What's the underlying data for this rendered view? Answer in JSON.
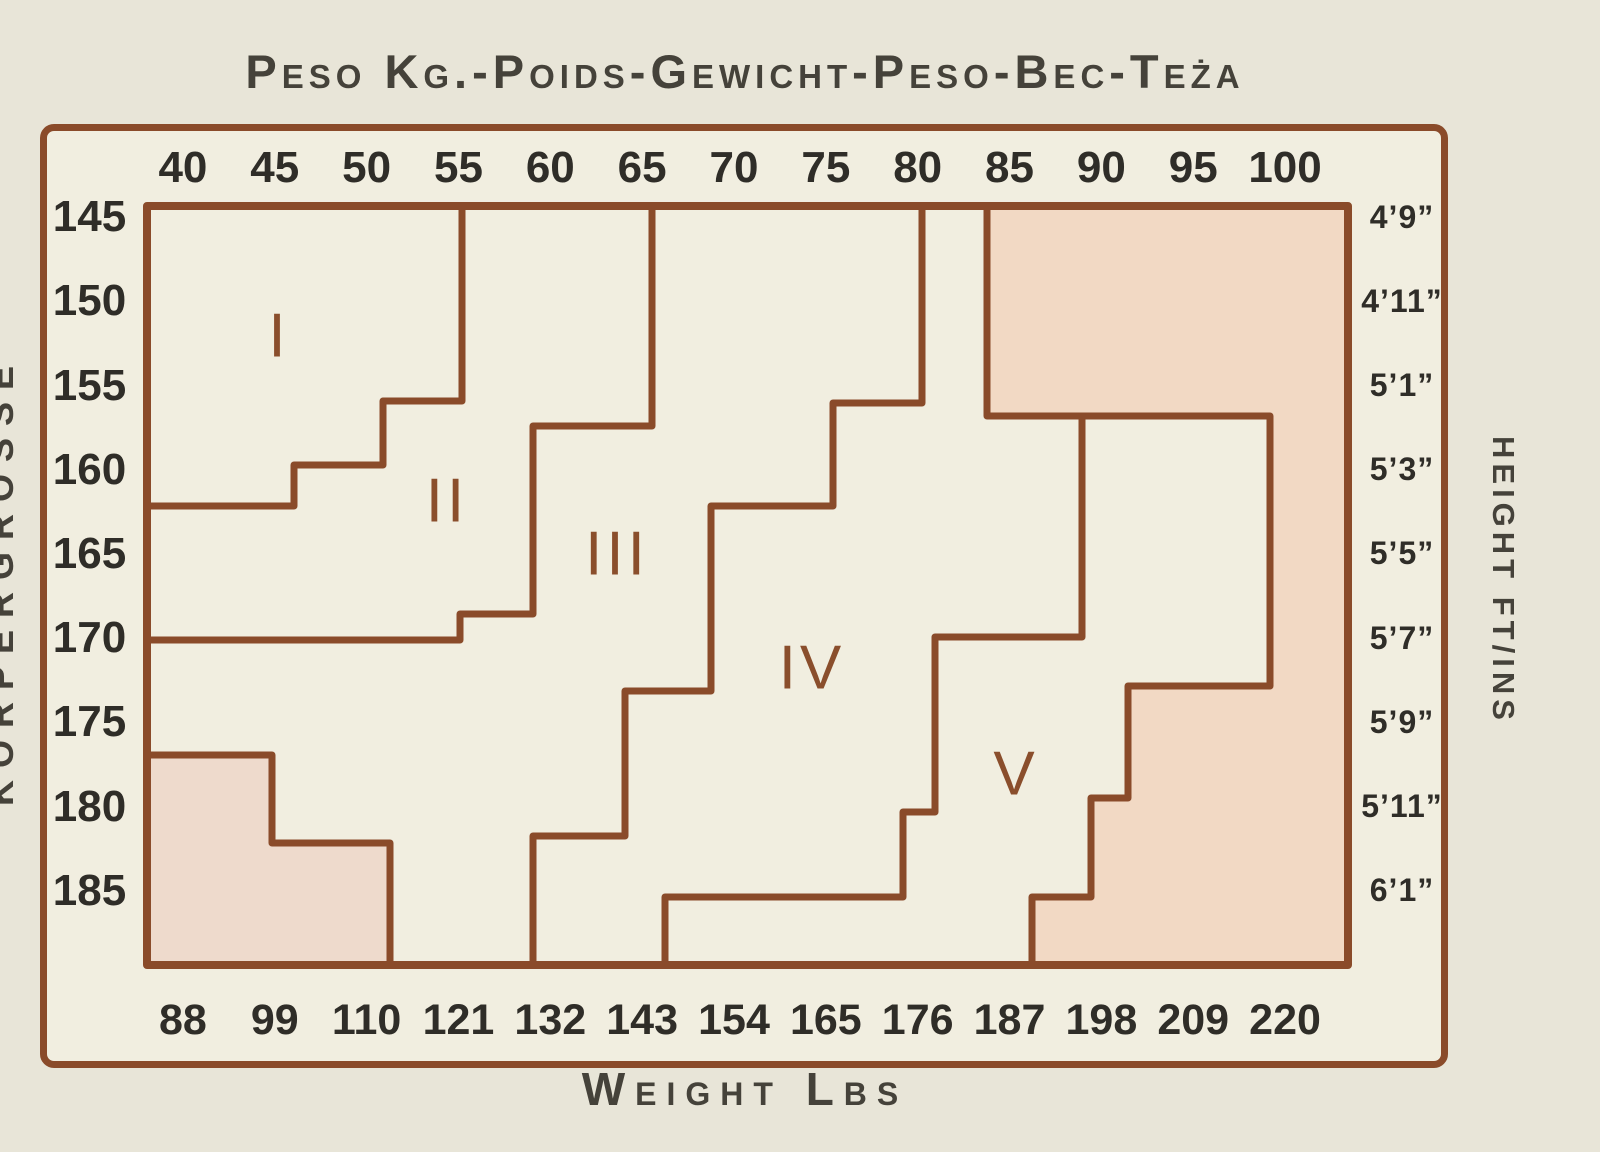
{
  "title": "Peso Kg.-Poids-Gewicht-Peso-Bec-Teża",
  "axes": {
    "weight_kg": [
      "40",
      "45",
      "50",
      "55",
      "60",
      "65",
      "70",
      "75",
      "80",
      "85",
      "90",
      "95",
      "100"
    ],
    "weight_lbs": [
      "88",
      "99",
      "110",
      "121",
      "132",
      "143",
      "154",
      "165",
      "176",
      "187",
      "198",
      "209",
      "220"
    ],
    "height_cm": [
      "145",
      "150",
      "155",
      "160",
      "165",
      "170",
      "175",
      "180",
      "185"
    ],
    "height_ftin": [
      "4’9”",
      "4’11”",
      "5’1”",
      "5’3”",
      "5’5”",
      "5’7”",
      "5’9”",
      "5’11”",
      "6’1”"
    ],
    "bottom_title": "Weight Lbs",
    "right_title": "HEIGHT FT/INS",
    "left_title": "KÖRPERGRÖSSE"
  },
  "colors": {
    "page_bg": "#e8e5d8",
    "chart_bg": "#f1eee0",
    "line": "#8a4b2a",
    "shaded_region": "#f2d9c4",
    "shaded_region_2": "#eedacc",
    "numeral": "#8a4e2c",
    "text": "#2f2d28"
  },
  "chart_data": {
    "type": "area",
    "subtype": "stepped-size-zone-lookup-chart",
    "title": "Peso Kg.-Poids-Gewicht-Peso-Bec-Teża",
    "xlabel_top_unit": "kg",
    "xlabel_bottom": "Weight Lbs",
    "ylabel_left_unit": "cm",
    "ylabel_right": "Height Ft/Ins",
    "x_ticks_kg": [
      40,
      45,
      50,
      55,
      60,
      65,
      70,
      75,
      80,
      85,
      90,
      95,
      100
    ],
    "x_ticks_lbs": [
      88,
      99,
      110,
      121,
      132,
      143,
      154,
      165,
      176,
      187,
      198,
      209,
      220
    ],
    "y_ticks_cm": [
      145,
      150,
      155,
      160,
      165,
      170,
      175,
      180,
      185
    ],
    "y_ticks_ftin": [
      "4'9\"",
      "4'11\"",
      "5'1\"",
      "5'3\"",
      "5'5\"",
      "5'7\"",
      "5'9\"",
      "5'11\"",
      "6'1\""
    ],
    "zones": [
      "I",
      "II",
      "III",
      "IV",
      "V"
    ],
    "grid": false,
    "legend": false,
    "geometry": {
      "inner_rect": {
        "x": 147,
        "y": 206,
        "w": 1201,
        "h": 759
      },
      "shaded_regions": [
        {
          "name": "out-of-range-upper-right",
          "points": [
            [
              987,
              206
            ],
            [
              1348,
              206
            ],
            [
              1348,
              965
            ],
            [
              1032,
              965
            ],
            [
              1032,
              897
            ],
            [
              1091,
              897
            ],
            [
              1091,
              798
            ],
            [
              1128,
              798
            ],
            [
              1128,
              686
            ],
            [
              1270,
              686
            ],
            [
              1270,
              416
            ],
            [
              987,
              416
            ]
          ]
        },
        {
          "name": "out-of-range-lower-left",
          "points": [
            [
              147,
              755
            ],
            [
              272,
              755
            ],
            [
              272,
              843
            ],
            [
              390,
              843
            ],
            [
              390,
              965
            ],
            [
              147,
              965
            ]
          ]
        }
      ],
      "zone_boundaries": [
        {
          "name": "boundary-I-II",
          "points": [
            [
              462,
              206
            ],
            [
              462,
              401
            ],
            [
              383,
              401
            ],
            [
              383,
              465
            ],
            [
              294,
              465
            ],
            [
              294,
              506
            ],
            [
              147,
              506
            ]
          ]
        },
        {
          "name": "boundary-II-III",
          "points": [
            [
              652,
              206
            ],
            [
              652,
              426
            ],
            [
              533,
              426
            ],
            [
              533,
              614
            ],
            [
              460,
              614
            ],
            [
              460,
              640
            ],
            [
              147,
              640
            ]
          ]
        },
        {
          "name": "boundary-III-IV",
          "points": [
            [
              922,
              206
            ],
            [
              922,
              403
            ],
            [
              833,
              403
            ],
            [
              833,
              506
            ],
            [
              711,
              506
            ],
            [
              711,
              691
            ],
            [
              625,
              691
            ],
            [
              625,
              836
            ],
            [
              533,
              836
            ],
            [
              533,
              965
            ]
          ]
        },
        {
          "name": "boundary-IV-V",
          "points": [
            [
              1082,
              416
            ],
            [
              1082,
              637
            ],
            [
              935,
              637
            ],
            [
              935,
              812
            ],
            [
              903,
              812
            ],
            [
              903,
              897
            ],
            [
              665,
              897
            ],
            [
              665,
              965
            ]
          ]
        }
      ],
      "zone_labels": [
        {
          "text": "I",
          "x": 279,
          "y": 340
        },
        {
          "text": "II",
          "x": 447,
          "y": 505
        },
        {
          "text": "III",
          "x": 617,
          "y": 558
        },
        {
          "text": "IV",
          "x": 812,
          "y": 672
        },
        {
          "text": "V",
          "x": 1016,
          "y": 778
        }
      ]
    }
  }
}
